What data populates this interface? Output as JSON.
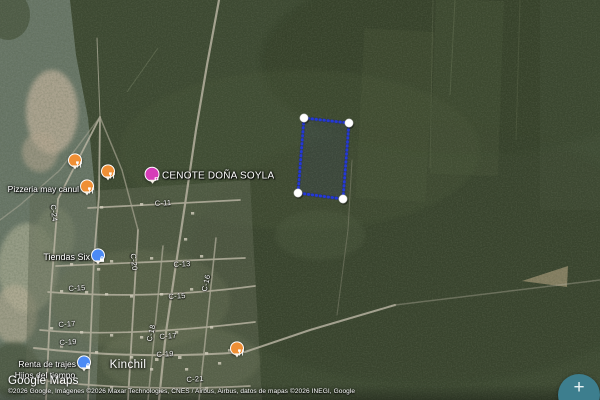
{
  "watermark": {
    "label": "Google Maps"
  },
  "attribution": {
    "copyright": "©2026 Google, Imágenes ©2026 Maxar Technologies, CNES / Airbus, Airbus, datos de mapas ©2026 INEGI, Google"
  },
  "controls": {
    "zoom_in_label": "+"
  },
  "town_label": "Kinchil",
  "pois": {
    "pizzeria": {
      "label": "Pizzeria may canul",
      "category": "restaurant",
      "pin_color": "#ef8f35"
    },
    "restaurant_nw": {
      "category": "restaurant",
      "pin_color": "#ef8f35"
    },
    "restaurant_mid": {
      "category": "restaurant",
      "pin_color": "#ef8f35"
    },
    "restaurant_east": {
      "category": "restaurant",
      "pin_color": "#ef8f35"
    },
    "cenote": {
      "label": "CENOTE DOÑA SOYLA",
      "category": "attraction",
      "pin_color": "#d63cb8"
    },
    "tiendas_six": {
      "label": "Tiendas Six",
      "category": "store",
      "pin_color": "#4b8af5"
    },
    "renta_de_trajes": {
      "label": "Renta de trajes",
      "category": "store",
      "pin_color": "#4b8af5"
    },
    "hijos_del_tiempo": {
      "label": "Hijos del tiempo",
      "category": "place"
    }
  },
  "street_labels": {
    "c11": "C-11",
    "c13": "C-13",
    "c15_w": "C-15",
    "c15_e": "C-15",
    "c17_w": "C-17",
    "c17_e": "C-17",
    "c19_w": "C-19",
    "c19_e": "C-19",
    "c21": "C-21",
    "c24": "C-24",
    "c20": "C-20",
    "c18": "C-18",
    "c16": "C-16"
  },
  "selection_polygon": {
    "stroke_color": "#2438d8",
    "corner_count": 4,
    "corner_points_px": [
      [
        304,
        118
      ],
      [
        349,
        123
      ],
      [
        343,
        199
      ],
      [
        298,
        193
      ]
    ]
  },
  "icons": {
    "restaurant_pin": "fork-and-knife",
    "attraction_pin": "attraction-badge",
    "store_pin": "shopping-bag",
    "zoom_in": "plus"
  },
  "colors": {
    "fab_background": "#3d7e8e",
    "road": "#b6b1a0",
    "forest": "#3c4831"
  }
}
